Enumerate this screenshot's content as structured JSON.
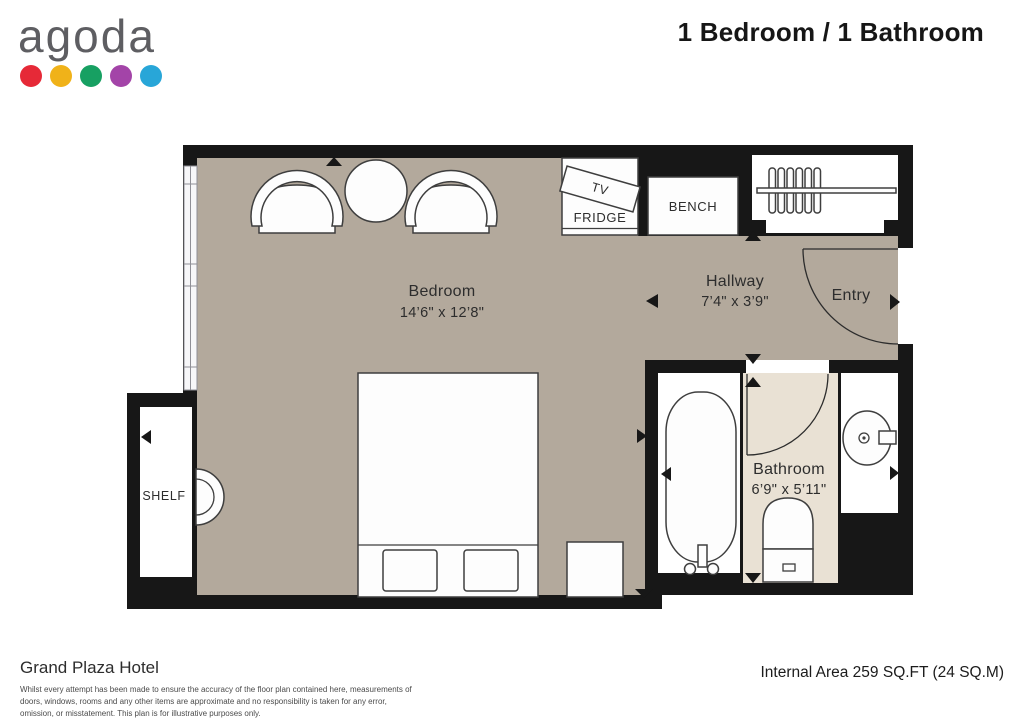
{
  "header": {
    "logo_text": "agoda",
    "logo_dot_colors": [
      "#e62937",
      "#f0b219",
      "#17a062",
      "#a344a8",
      "#28a6d8"
    ],
    "title": "1 Bedroom / 1 Bathroom"
  },
  "plan": {
    "colors": {
      "wall": "#171717",
      "floor_main": "#b3a99c",
      "floor_bathroom": "#e9e1d4",
      "furniture": "#fdfdfd",
      "outline": "#3e3e3e",
      "label": "#2d2d2d"
    },
    "rooms": {
      "bedroom": {
        "label": "Bedroom",
        "dims": "14’6\" x 12’8\""
      },
      "hallway": {
        "label": "Hallway",
        "dims": "7’4\" x 3’9\""
      },
      "entry": {
        "label": "Entry"
      },
      "bathroom": {
        "label": "Bathroom",
        "dims": "6’9\" x 5’11\""
      },
      "shelf": {
        "label": "SHELF"
      }
    },
    "fixtures": {
      "tv": "TV",
      "fridge": "FRIDGE",
      "bench": "BENCH"
    }
  },
  "footer": {
    "property_name": "Grand Plaza Hotel",
    "disclaimer": "Whilst every attempt has been made to ensure the accuracy of the floor plan contained here, measurements of doors, windows, rooms and any other items are approximate and no responsibility is taken for any error, omission, or misstatement. This plan is for illustrative purposes only.",
    "area_text": "Internal Area 259 SQ.FT (24 SQ.M)"
  }
}
